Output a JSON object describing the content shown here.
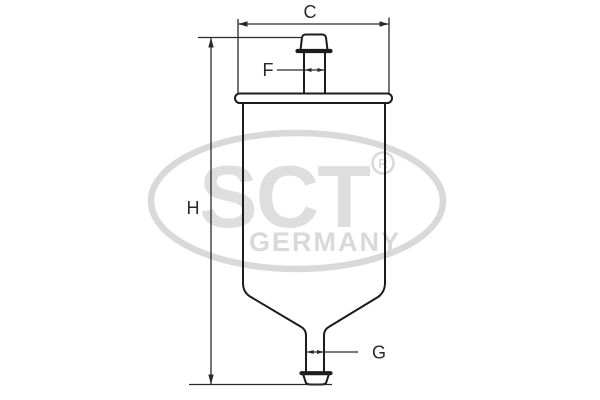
{
  "diagram": {
    "type": "technical-drawing",
    "subject": "in-line fuel filter, side elevation with dimension callouts",
    "dimensions": {
      "width_top": "C",
      "inlet_diameter": "F",
      "height": "H",
      "outlet_diameter": "G"
    }
  },
  "watermark": {
    "brand": "SCT",
    "registered_mark": "R",
    "country": "GERMANY"
  },
  "colors": {
    "background": "#ffffff",
    "line": "#1c1c1c",
    "dimension": "#2a2a2a",
    "watermark_gray": "#d9d9d9"
  }
}
